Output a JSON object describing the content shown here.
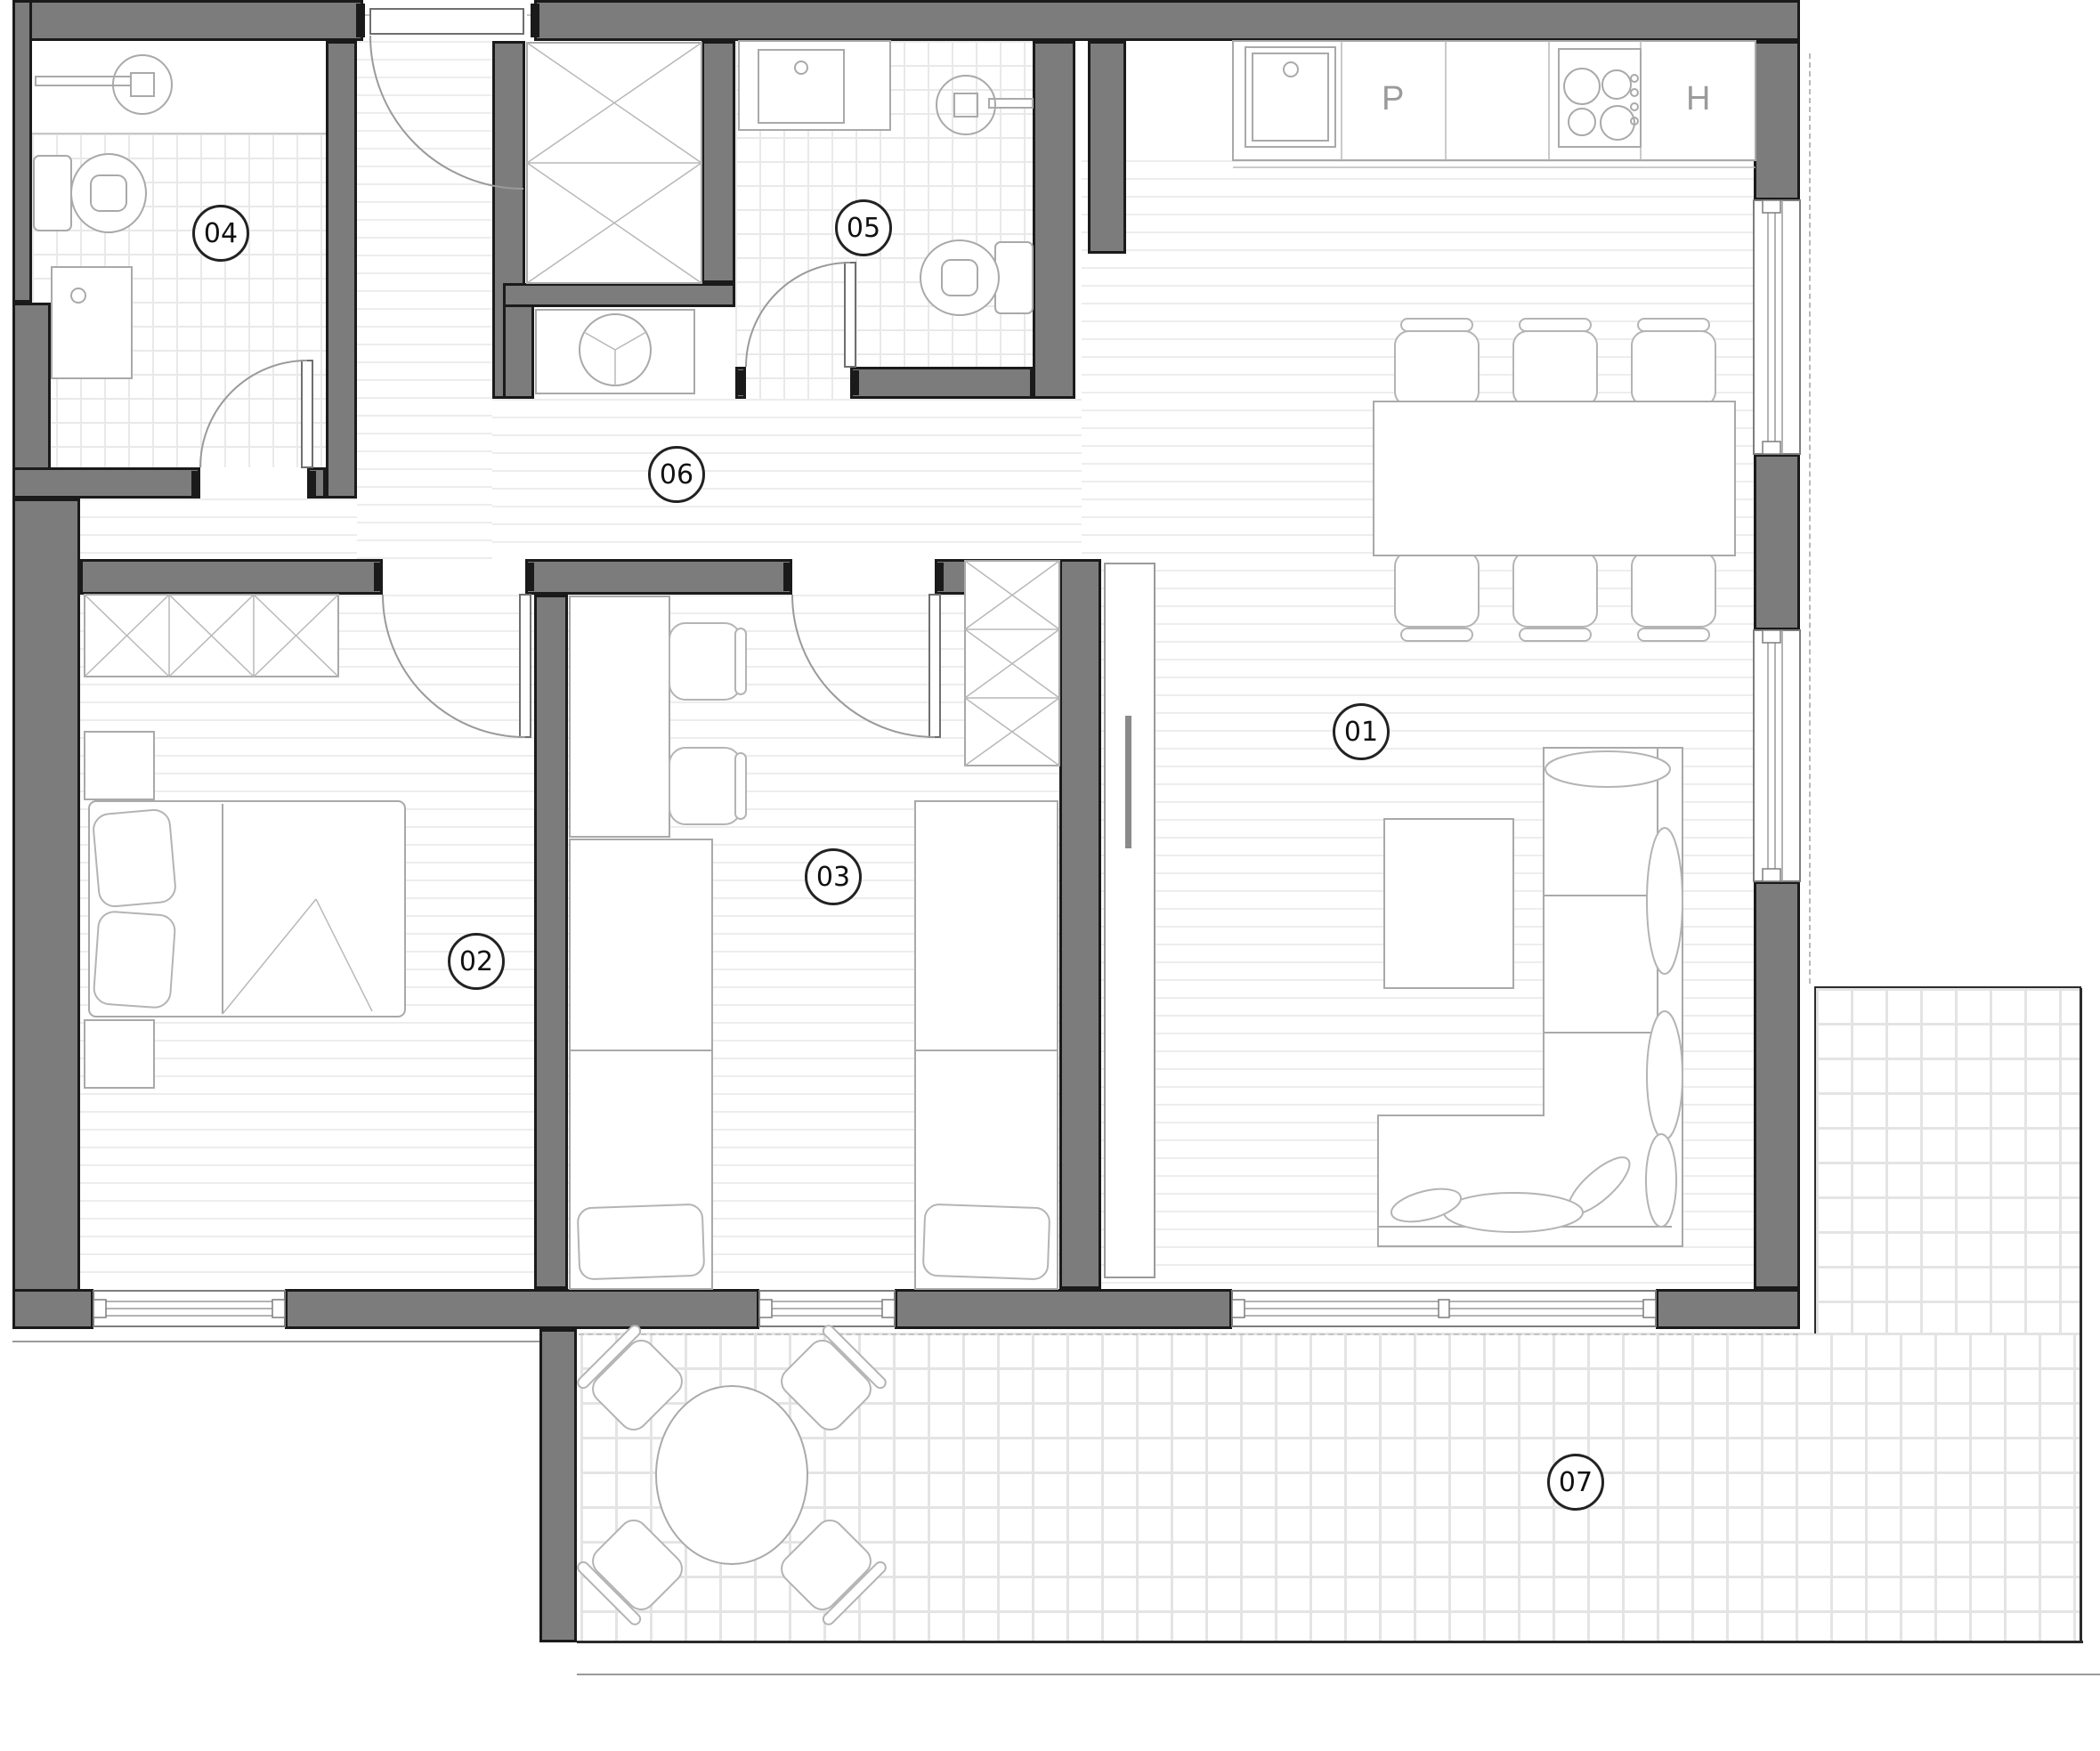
{
  "title": "apartment-floor-plan",
  "rooms": [
    {
      "id": "01",
      "label": "01",
      "name": "living-dining-kitchen"
    },
    {
      "id": "02",
      "label": "02",
      "name": "bedroom"
    },
    {
      "id": "03",
      "label": "03",
      "name": "children-bedroom"
    },
    {
      "id": "04",
      "label": "04",
      "name": "bathroom"
    },
    {
      "id": "05",
      "label": "05",
      "name": "bathroom-laundry"
    },
    {
      "id": "06",
      "label": "06",
      "name": "hallway"
    },
    {
      "id": "07",
      "label": "07",
      "name": "terrace"
    }
  ],
  "kitchen": {
    "dishwasher_label": "P",
    "oven_label": "H"
  },
  "colors": {
    "wall": "#7c7c7c",
    "wall_edge": "#1a1a1a",
    "furniture_line": "#a9a9a9",
    "wood_hatch_line": "#ededed",
    "bath_tile_line": "#e9e9e9",
    "terrace_tile_line": "#e4e4e4",
    "label_text": "#111111",
    "kitchen_label_text": "#9b9b9b"
  },
  "fixtures": [
    "shower-icon",
    "toilet-icon",
    "washbasin-icon",
    "washing-machine-icon",
    "kitchen-sink-icon",
    "cooktop-icon",
    "wardrobe-icon",
    "double-bed-icon",
    "single-bed-icon",
    "desk-icon",
    "chair-icon",
    "dining-table-icon",
    "sofa-icon",
    "coffee-table-icon",
    "terrace-table-icon",
    "door-icon",
    "window-icon"
  ]
}
